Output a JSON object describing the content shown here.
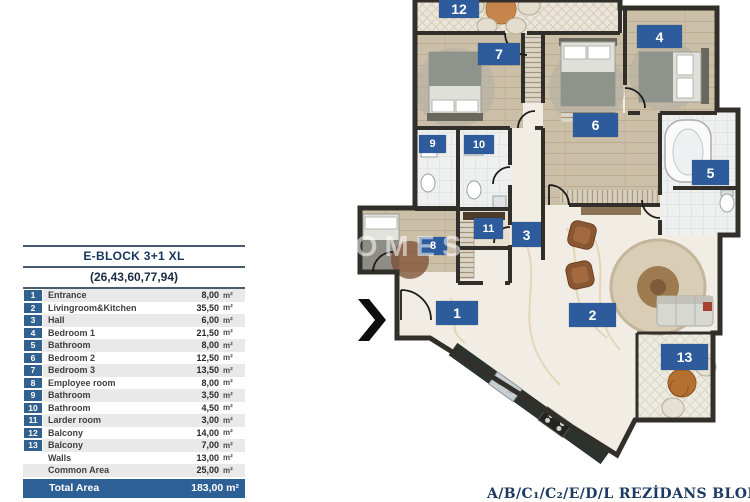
{
  "legend": {
    "title": "E-BLOCK  3+1 XL",
    "subtitle": "(26,43,60,77,94)",
    "unit": "m²",
    "rows": [
      {
        "num": "1",
        "name": "Entrance",
        "value": "8,00"
      },
      {
        "num": "2",
        "name": "Livingroom&Kitchen",
        "value": "35,50"
      },
      {
        "num": "3",
        "name": "Hall",
        "value": "6,00"
      },
      {
        "num": "4",
        "name": "Bedroom 1",
        "value": "21,50"
      },
      {
        "num": "5",
        "name": "Bathroom",
        "value": "8,00"
      },
      {
        "num": "6",
        "name": "Bedroom 2",
        "value": "12,50"
      },
      {
        "num": "7",
        "name": "Bedroom 3",
        "value": "13,50"
      },
      {
        "num": "8",
        "name": "Employee room",
        "value": "8,00"
      },
      {
        "num": "9",
        "name": "Bathroom",
        "value": "3,50"
      },
      {
        "num": "10",
        "name": "Bathroom",
        "value": "4,50"
      },
      {
        "num": "11",
        "name": "Larder room",
        "value": "3,00"
      },
      {
        "num": "12",
        "name": "Balcony",
        "value": "14,00"
      },
      {
        "num": "13",
        "name": "Balcony",
        "value": "7,00"
      },
      {
        "num": "",
        "name": "Walls",
        "value": "13,00"
      },
      {
        "num": "",
        "name": "Common Area",
        "value": "25,00"
      }
    ],
    "total": {
      "name": "Total Area",
      "value": "183,00 m²"
    }
  },
  "plan": {
    "badges": [
      "1",
      "2",
      "3",
      "4",
      "5",
      "6",
      "7",
      "8",
      "9",
      "10",
      "11",
      "12",
      "13"
    ],
    "watermark": "HOMES"
  },
  "footer": {
    "text": "A/B/C₁/C₂/E/D/L REZİDANS BLOKLAR"
  },
  "colors": {
    "badge_blue": "#2d5b9c",
    "table_number_blue": "#31618f",
    "total_row_blue": "#2d6094",
    "header_navy": "#16365c",
    "wall": "#322f2a",
    "wood_floor": "#ccbfa8",
    "marble_floor": "#f1ede4"
  }
}
